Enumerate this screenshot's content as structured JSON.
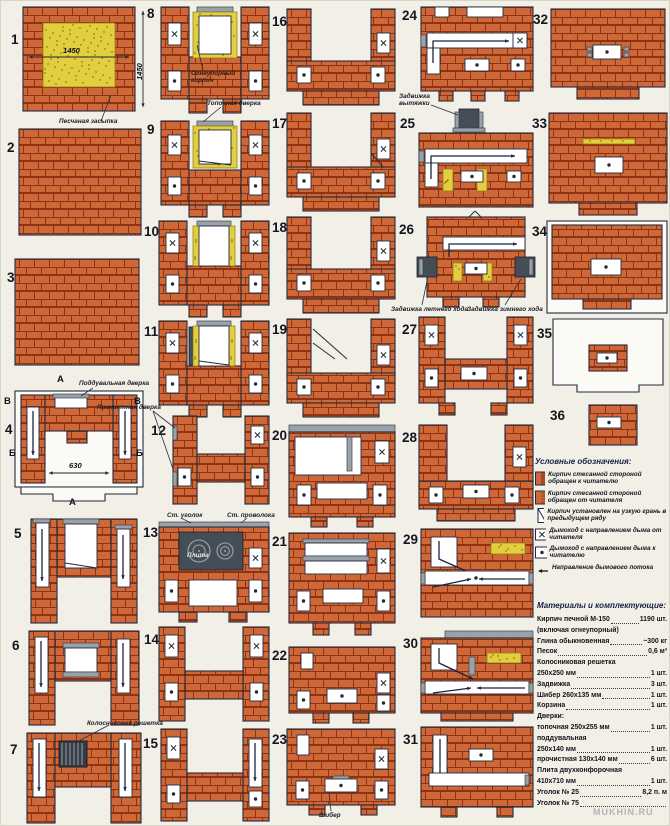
{
  "diagrams": {
    "numbers": [
      "1",
      "2",
      "3",
      "4",
      "5",
      "6",
      "7",
      "8",
      "9",
      "10",
      "11",
      "12",
      "13",
      "14",
      "15",
      "16",
      "17",
      "18",
      "19",
      "20",
      "21",
      "22",
      "23",
      "24",
      "25",
      "26",
      "27",
      "28",
      "29",
      "30",
      "31",
      "32",
      "33",
      "34",
      "35",
      "36"
    ]
  },
  "annotations": [
    {
      "t": "1450",
      "x": 62,
      "y": 46,
      "c": "dim"
    },
    {
      "t": "1450",
      "x": 135,
      "y": 79,
      "c": "dim vdim"
    },
    {
      "t": "Песчаная засыпка",
      "x": 58,
      "y": 118,
      "c": "note"
    },
    {
      "t": "Огнеупорный\nкирпич",
      "x": 190,
      "y": 70,
      "c": "note"
    },
    {
      "t": "Топочная дверка",
      "x": 206,
      "y": 100,
      "c": "note"
    },
    {
      "t": "А",
      "x": 56,
      "y": 374,
      "c": "marker"
    },
    {
      "t": "Поддувальная дверка",
      "x": 78,
      "y": 380,
      "c": "note"
    },
    {
      "t": "В",
      "x": 3,
      "y": 396,
      "c": "marker"
    },
    {
      "t": "В",
      "x": 133,
      "y": 396,
      "c": "marker"
    },
    {
      "t": "Прочистная дверка",
      "x": 96,
      "y": 404,
      "c": "note"
    },
    {
      "t": "Б",
      "x": 8,
      "y": 448,
      "c": "marker"
    },
    {
      "t": "Б",
      "x": 135,
      "y": 448,
      "c": "marker"
    },
    {
      "t": "630",
      "x": 68,
      "y": 461,
      "c": "dim"
    },
    {
      "t": "А",
      "x": 68,
      "y": 497,
      "c": "marker"
    },
    {
      "t": "Ст. уголок",
      "x": 166,
      "y": 512,
      "c": "note"
    },
    {
      "t": "Ст. проволока",
      "x": 226,
      "y": 512,
      "c": "note"
    },
    {
      "t": "Плита",
      "x": 186,
      "y": 552,
      "c": "note on-dark"
    },
    {
      "t": "Колосниковая решетка",
      "x": 86,
      "y": 720,
      "c": "note"
    },
    {
      "t": "Шибер",
      "x": 318,
      "y": 812,
      "c": "note"
    },
    {
      "t": "Задвижка\nвытяжки",
      "x": 398,
      "y": 93,
      "c": "note"
    },
    {
      "t": "Задвижка летнего хода",
      "x": 390,
      "y": 306,
      "c": "note"
    },
    {
      "t": "Задвижка зимнего хода",
      "x": 466,
      "y": 306,
      "c": "note"
    }
  ],
  "legend": {
    "title": "Условные обозначения:",
    "items": [
      {
        "icon": "brick-hatched",
        "text": "Кирпич стесанной стороной обращен к читателю"
      },
      {
        "icon": "brick-dotted",
        "text": "Кирпич стесанной стороной обращен от читателя"
      },
      {
        "icon": "brick-edge",
        "text": "Кирпич установлен на узкую грань в предыдущем ряду"
      },
      {
        "icon": "flue-away",
        "text": "Дымоход с направлением дыма  от читателя"
      },
      {
        "icon": "flue-toward",
        "text": "Дымоход с направлением дыма  к читателю"
      },
      {
        "icon": "flow-arrow",
        "text": "Направление дымового потока"
      }
    ]
  },
  "materials": {
    "title": "Материалы и комплектующие:",
    "lines": [
      {
        "label": "Кирпич печной М-150",
        "value": "1190 шт.",
        "dots": true
      },
      {
        "label": "(включая огнеупорный)",
        "value": "",
        "dots": false
      },
      {
        "label": "Глина обыкновенная",
        "value": "~300 кг",
        "dots": true
      },
      {
        "label": "Песок",
        "value": "0,6 м³",
        "dots": true
      },
      {
        "label": "Колосниковая решетка",
        "value": "",
        "dots": false
      },
      {
        "label": "250х250 мм",
        "value": "1 шт.",
        "dots": true
      },
      {
        "label": "Задвижка",
        "value": "3 шт.",
        "dots": true
      },
      {
        "label": "Шибер 260х135 мм",
        "value": "1 шт.",
        "dots": true
      },
      {
        "label": "Корзина",
        "value": "1 шт.",
        "dots": true
      },
      {
        "label": "Дверки:",
        "value": "",
        "dots": false
      },
      {
        "label": "топочная 250х255 мм",
        "value": "1 шт.",
        "dots": true
      },
      {
        "label": "поддувальная",
        "value": "",
        "dots": false
      },
      {
        "label": "250х140 мм",
        "value": "1 шт.",
        "dots": true
      },
      {
        "label": "прочистная 130х140 мм",
        "value": "6 шт.",
        "dots": true
      },
      {
        "label": "Плита двухконфорочная",
        "value": "",
        "dots": false
      },
      {
        "label": "410х710 мм",
        "value": "1 шт.",
        "dots": true
      },
      {
        "label": "Уголок № 25",
        "value": "8,2 п. м",
        "dots": true
      },
      {
        "label": "Уголок № 75",
        "value": "",
        "dots": true
      }
    ]
  },
  "watermark": "MUKHIN.RU",
  "colors": {
    "brick": "#cf6838",
    "mortar": "#8d3312",
    "outline": "#232a3c",
    "sand": "#e2ce3e",
    "steel": "#99a2aa",
    "dark": "#454d56",
    "paper": "#f2efe7"
  }
}
